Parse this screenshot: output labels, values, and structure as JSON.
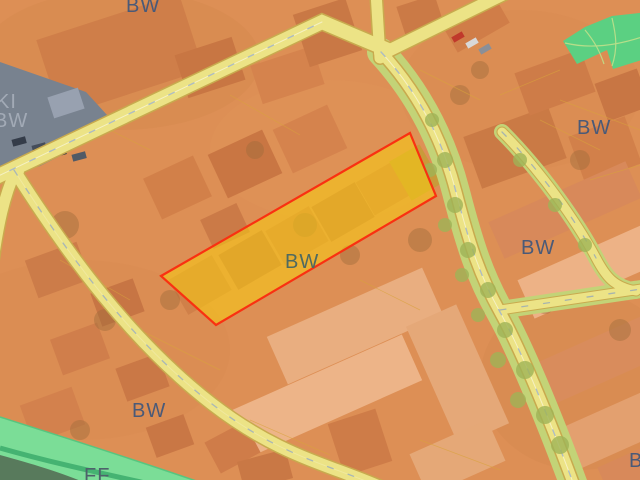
{
  "map": {
    "type": "zoning-overlay-on-aerial-imagery",
    "labels": {
      "bw_top": "BW",
      "ki_left_line1": "KI",
      "ki_left_line2": "BW",
      "bw_right_upper": "BW",
      "bw_right_mid": "BW",
      "bw_center": "BW",
      "bw_bottom_left": "BW",
      "bw_bottom_right": "BW",
      "ff_bottom": "FF"
    },
    "colors": {
      "residential_overlay_orange": "#dd8f55",
      "road_fill_yellow": "#ece386",
      "road_casing": "#c8aa4e",
      "street_verge_green": "#c3d377",
      "park_green": "#5bd082",
      "greenway_band": "#7bdd97",
      "stream_green": "#3fae6e",
      "dark_green_area": "#587a5c",
      "parking_lot_gray": "#78828f",
      "selected_parcel_fill": "#f8cd12",
      "selected_parcel_border": "#f93111",
      "zone_label_blue": "#4a5a78",
      "zone_label_light_gray": "#a2aab6"
    },
    "selection": {
      "highlighted_parcel_present": true,
      "highlighted_parcel_zone": "BW"
    }
  }
}
